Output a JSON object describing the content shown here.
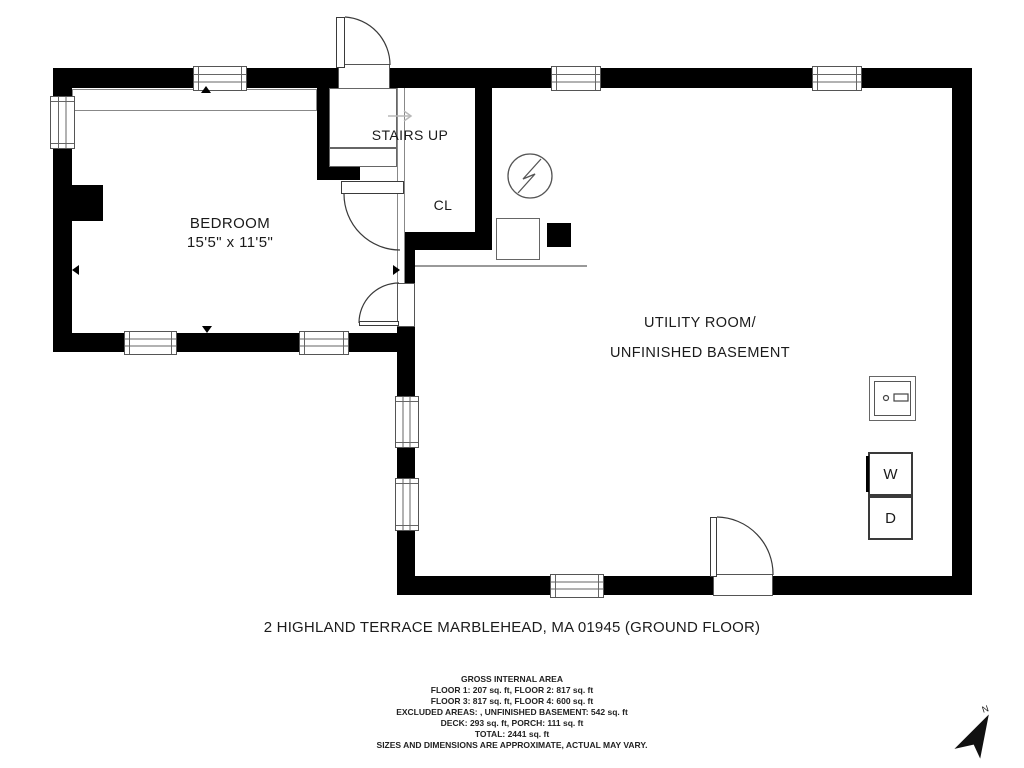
{
  "colors": {
    "wall": "#000000",
    "outline": "#555555",
    "text": "#1a1a1a"
  },
  "floor_plan": {
    "bedroom": {
      "name": "BEDROOM",
      "dimensions": "15'5\" x 11'5\""
    },
    "stairs": {
      "label": "STAIRS UP"
    },
    "closet": {
      "label": "CL"
    },
    "utility_room": {
      "name_line1": "UTILITY ROOM/",
      "name_line2": "UNFINISHED BASEMENT"
    },
    "appliances": {
      "washer_label": "W",
      "dryer_label": "D"
    },
    "compass": {
      "north_label": "N"
    }
  },
  "footer": {
    "title": "2 HIGHLAND TERRACE MARBLEHEAD, MA 01945 (GROUND FLOOR)",
    "area_summary": {
      "heading": "GROSS INTERNAL AREA",
      "lines": [
        "FLOOR 1: 207 sq. ft, FLOOR 2: 817 sq. ft",
        "FLOOR 3: 817 sq. ft, FLOOR 4: 600 sq. ft",
        "EXCLUDED AREAS: , UNFINISHED BASEMENT: 542 sq. ft",
        "DECK: 293 sq. ft, PORCH: 111 sq. ft",
        "TOTAL: 2441 sq. ft"
      ],
      "disclaimer": "SIZES AND DIMENSIONS ARE APPROXIMATE, ACTUAL MAY VARY."
    }
  }
}
